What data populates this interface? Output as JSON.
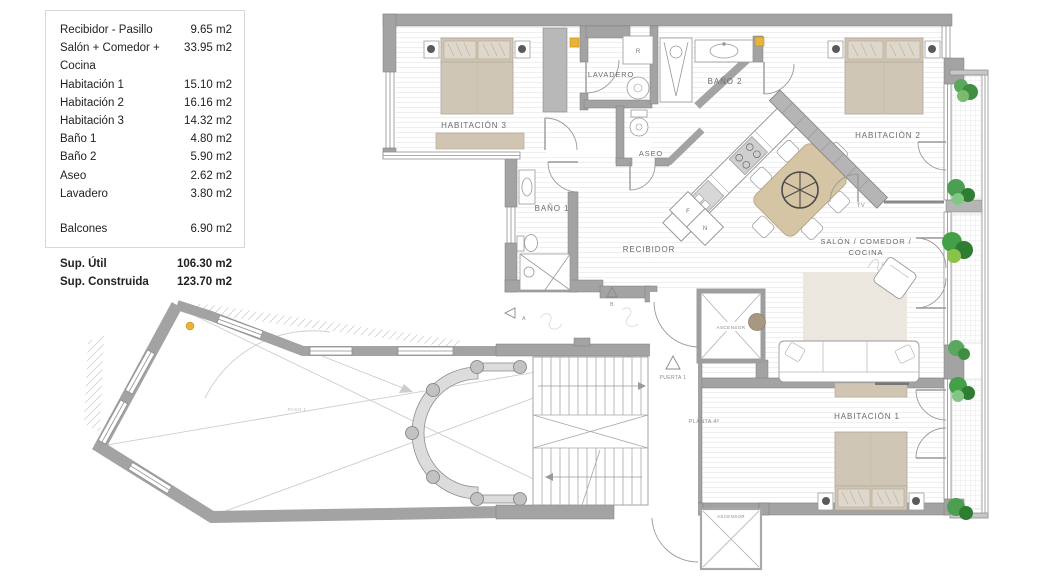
{
  "legend": {
    "rows": [
      {
        "label": "Recibidor - Pasillo",
        "value": "9.65 m2"
      },
      {
        "label": "Salón + Comedor + Cocina",
        "value": "33.95 m2"
      },
      {
        "label": "Habitación 1",
        "value": "15.10 m2"
      },
      {
        "label": "Habitación 2",
        "value": "16.16 m2"
      },
      {
        "label": "Habitación 3",
        "value": "14.32 m2"
      },
      {
        "label": "Baño 1",
        "value": "4.80 m2"
      },
      {
        "label": "Baño 2",
        "value": "5.90 m2"
      },
      {
        "label": "Aseo",
        "value": "2.62 m2"
      },
      {
        "label": "Lavadero",
        "value": "3.80 m2"
      },
      {
        "label": "Balcones",
        "value": "6.90 m2"
      },
      {
        "label": "Sup. Útil",
        "value": "106.30 m2"
      },
      {
        "label": "Sup. Construida",
        "value": "123.70 m2"
      }
    ]
  },
  "plan": {
    "rooms": {
      "hab3": "HABITACIÓN 3",
      "lavadero": "LAVADERO",
      "bano2": "BAÑO 2",
      "hab2": "HABITACIÓN 2",
      "aseo": "ASEO",
      "bano1": "BAÑO 1",
      "recibidor": "RECIBIDOR",
      "salon_l1": "SALÓN / COMEDOR /",
      "salon_l2": "COCINA",
      "hab1": "HABITACIÓN 1"
    },
    "labels": {
      "tv": "TV",
      "ascensor": "ASCENSOR",
      "puerta": "PUERTA 1",
      "planta": "PLANTA 4ª",
      "paso": "PASO 1"
    },
    "letters": {
      "f": "F",
      "n": "N",
      "r": "R",
      "a": "A",
      "b": "B"
    }
  },
  "colors": {
    "wall": "#a3a3a3",
    "accent_yellow": "#e8b33a",
    "plant_green": "#4c9e50",
    "furniture_tan": "#cfc5b2"
  }
}
